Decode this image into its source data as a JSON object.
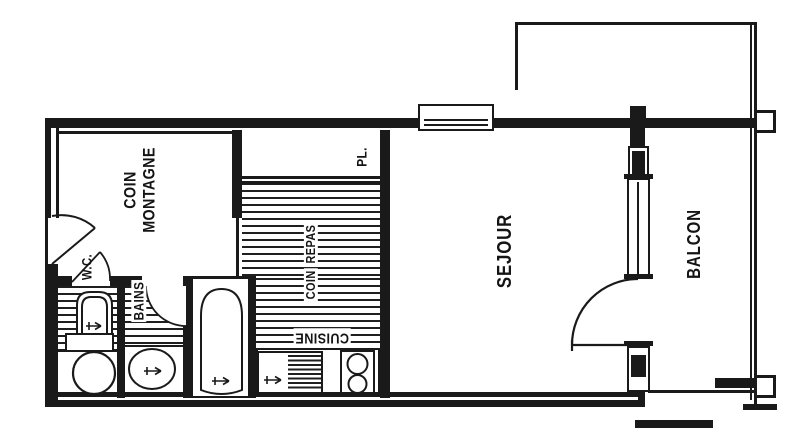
{
  "plan": {
    "rooms": {
      "coin_montagne": {
        "line1": "COIN",
        "line2": "MONTAGNE"
      },
      "wc": {
        "label": "W.C."
      },
      "bains": {
        "label": "BAINS"
      },
      "coin_repas": {
        "line1": "COIN",
        "line2": "REPAS"
      },
      "cuisine": {
        "label": "CUISINE"
      },
      "placard": {
        "label": "PL."
      },
      "sejour": {
        "label": "SEJOUR"
      },
      "balcon": {
        "label": "BALCON"
      }
    },
    "colors": {
      "line": "#1a1a1a",
      "background": "#ffffff",
      "hatch_line": "#1f1f1f"
    }
  }
}
